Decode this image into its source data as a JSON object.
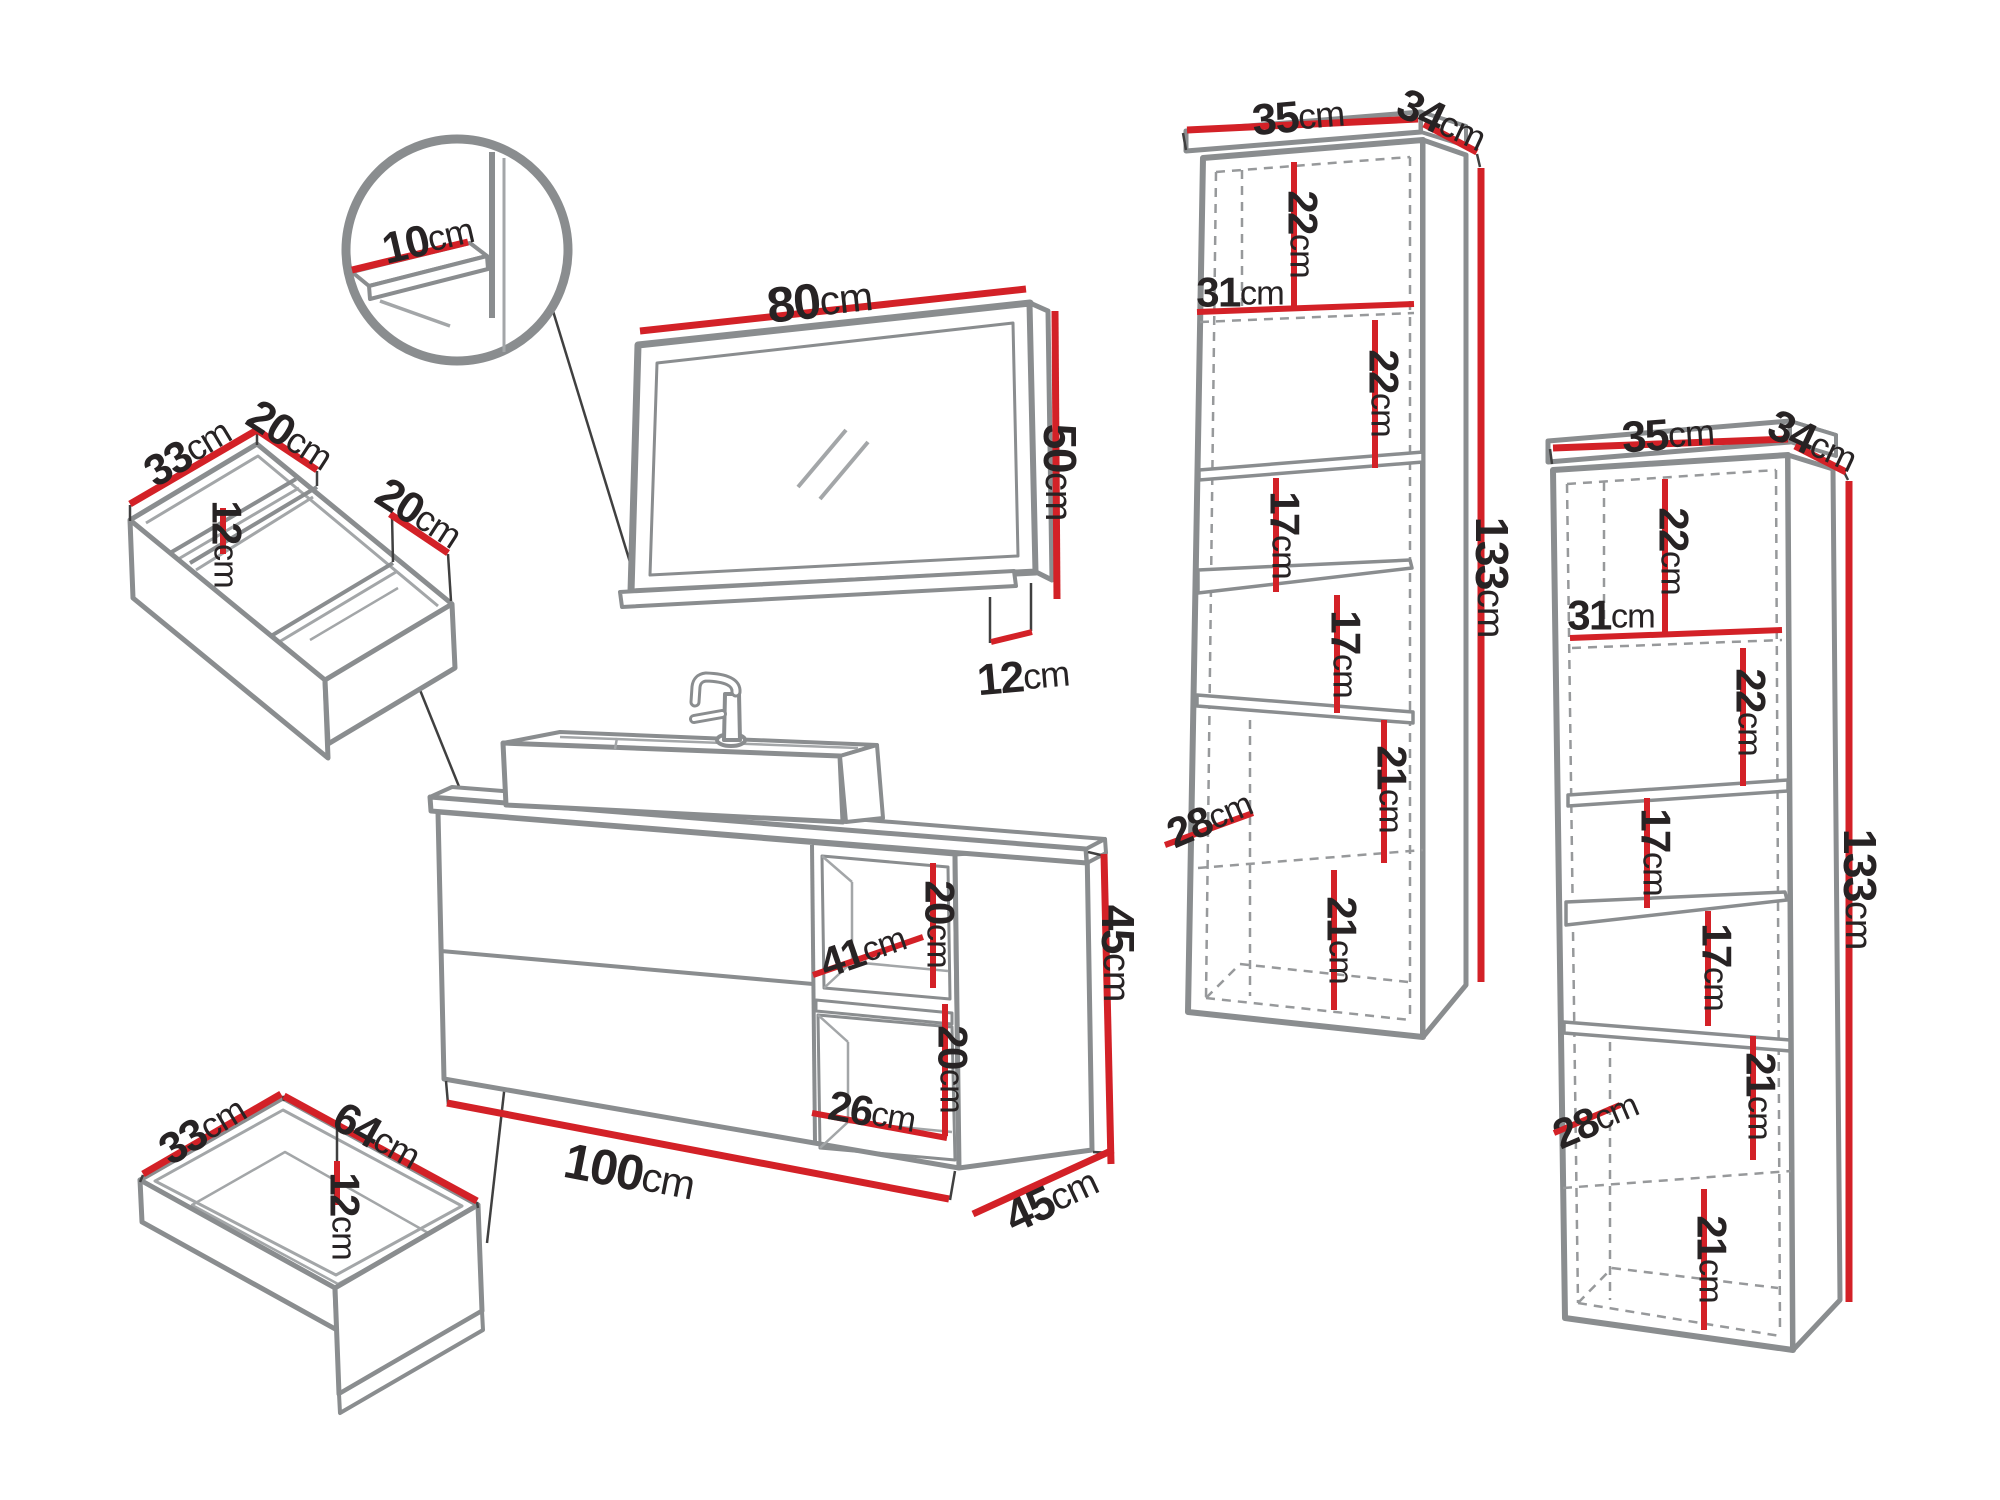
{
  "unit": "cm",
  "colors": {
    "dimension_red": "#d32127",
    "outline_gray": "#8a8d8f",
    "dashed_gray": "#97999b",
    "text_dark": "#272324",
    "background": "#ffffff"
  },
  "detail_circle": {
    "shelf_depth": "10"
  },
  "mirror": {
    "width": "80",
    "height": "50",
    "shelf_depth": "12"
  },
  "drawer_organizer": {
    "depth": "33",
    "left_compartment_width": "20",
    "divider_height": "12",
    "right_compartment_width": "20"
  },
  "lower_drawer": {
    "depth": "33",
    "width": "64",
    "inner_height": "12"
  },
  "vanity": {
    "open_shelf_depth": "41",
    "upper_cubby_height": "20",
    "lower_cubby_height": "20",
    "cubby_width": "26",
    "width": "100",
    "height": "45",
    "depth": "45"
  },
  "tall_cabinet_left": {
    "width": "35",
    "depth": "34",
    "height": "133",
    "top_section_height": "22",
    "inner_width": "31",
    "second_section_height": "22",
    "third_section_height": "17",
    "fourth_section_height": "17",
    "fifth_section_height": "21",
    "inner_depth": "28",
    "bottom_section_height": "21"
  },
  "tall_cabinet_right": {
    "width": "35",
    "depth": "34",
    "height": "133",
    "top_section_height": "22",
    "inner_width": "31",
    "second_section_height": "22",
    "third_section_height": "17",
    "fourth_section_height": "17",
    "fifth_section_height": "21",
    "inner_depth": "28",
    "bottom_section_height": "21"
  }
}
